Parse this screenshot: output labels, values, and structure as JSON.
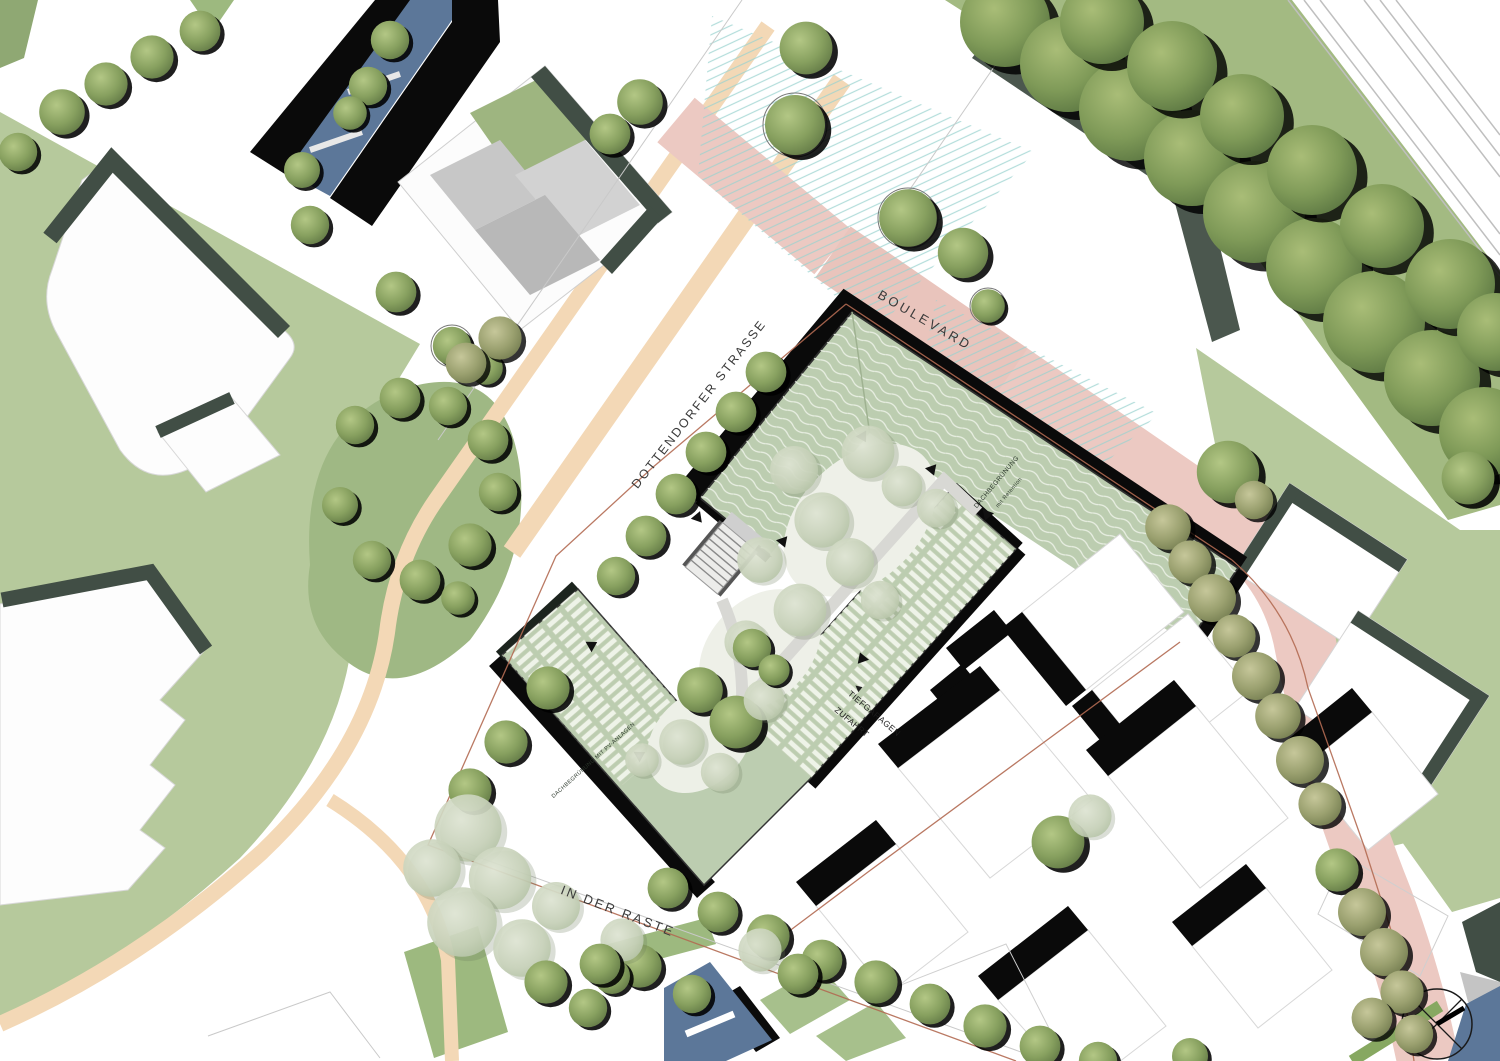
{
  "map": {
    "streets": {
      "boulevard": "BOULEVARD",
      "dottendorfer_strasse": "DOTTENDORFER STRASSE",
      "in_der_raste": "IN DER RASTE"
    },
    "annotations": {
      "garage_arrow": "◀",
      "garage_line1": "TIEFGARAGEN",
      "garage_line2": "ZUFAHRT",
      "roof_retention_line1": "DACHBEGRÜNUNG",
      "roof_retention_line2": "mit Retention",
      "roof_pv": "DACHBEGRÜNUNG MIT PV-ANLAGEN"
    },
    "symbols": {
      "north_arrow": "compass-crosshair"
    },
    "palette": {
      "lawn": "#b6c99c",
      "park": "#a3ba82",
      "roof_green": "#bccdb0",
      "pv_panel": "#edf2e6",
      "boulevard_pink": "#ecc9c2",
      "path_tan": "#f3d8b6",
      "water_blue": "#5c7799",
      "shadow_sage": "#414e45",
      "shadow_black": "#0a0a0a",
      "hatch_teal": "#9ad2cf",
      "boundary_red": "#b26a52"
    }
  }
}
